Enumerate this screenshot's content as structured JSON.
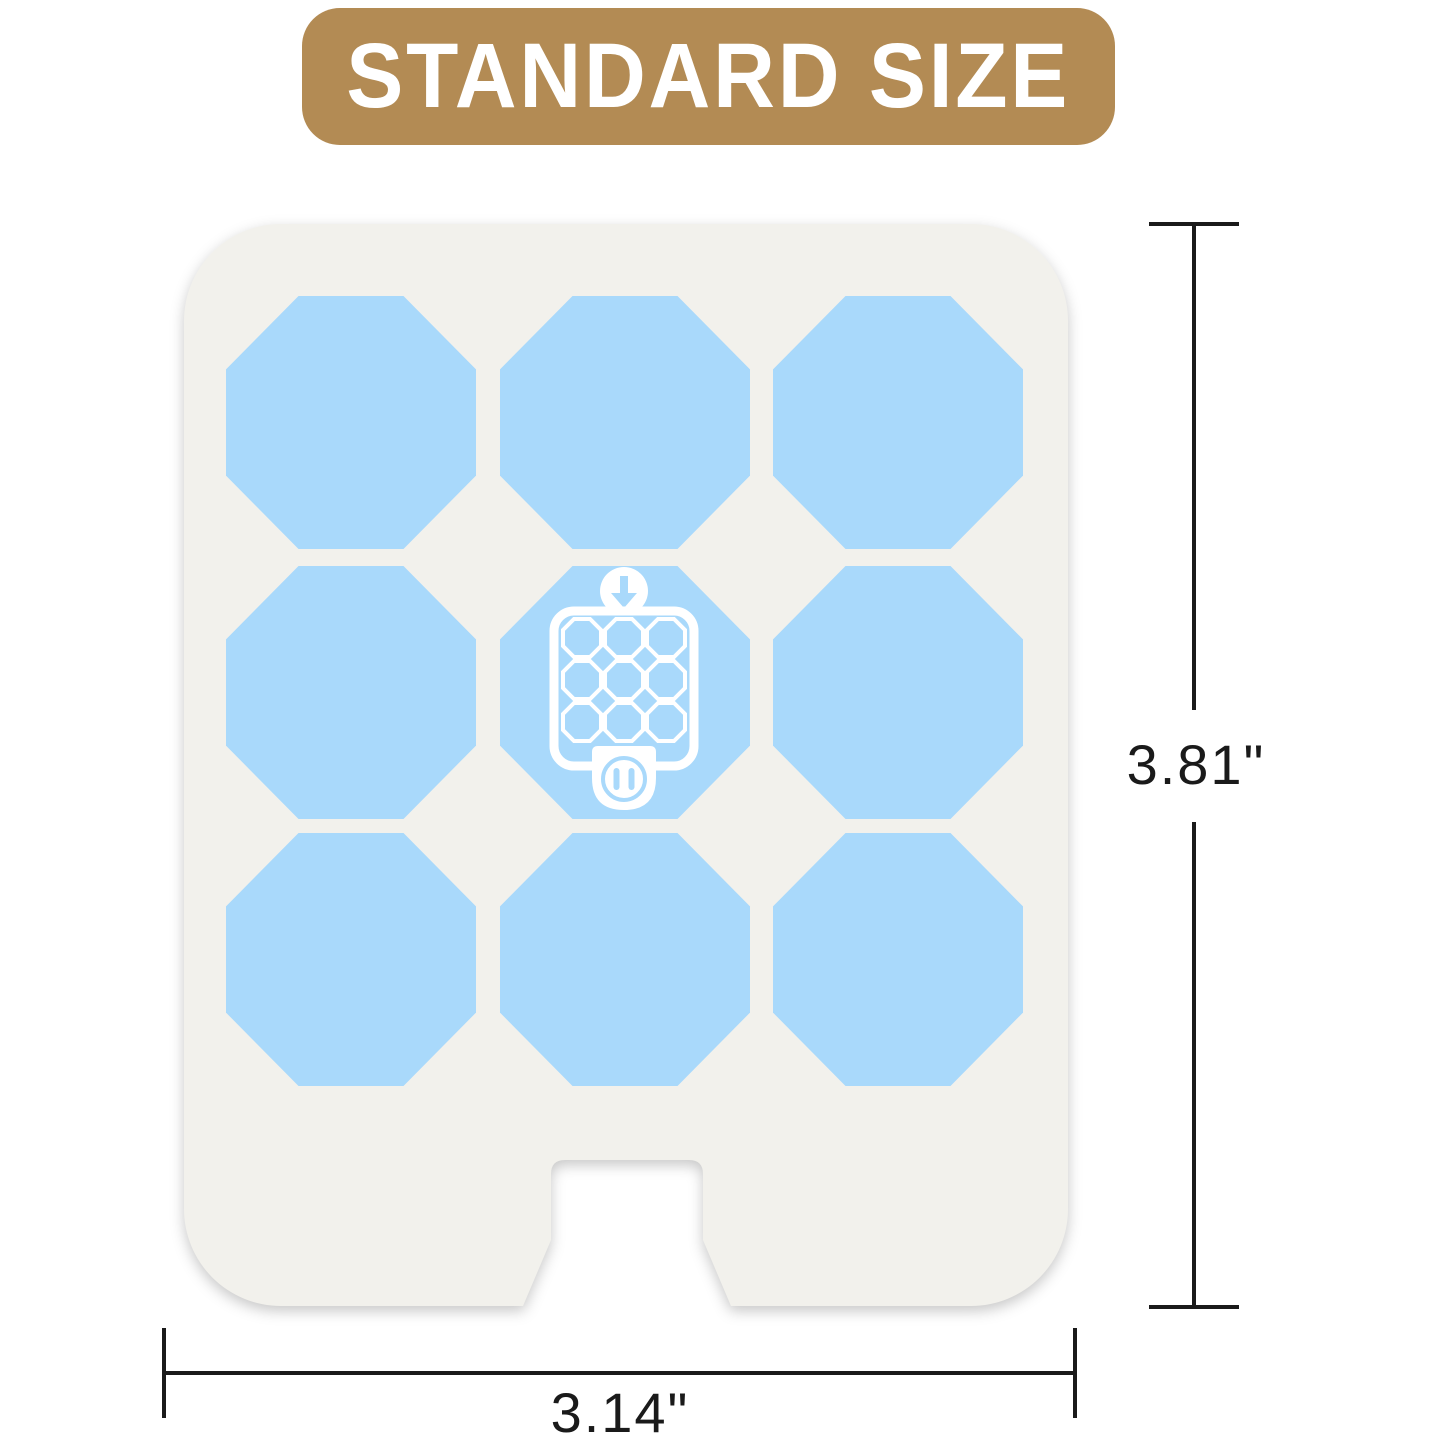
{
  "badge": {
    "label": "STANDARD SIZE"
  },
  "pad": {
    "description": "refill pad sheet with octagon scent pads",
    "octagon_rows": 3,
    "octagon_cols": 3,
    "octagon_count": 9,
    "center_icon": {
      "name": "plug-in-diffuser-icon",
      "elements": [
        "down-arrow-icon",
        "refill-grid-icon",
        "outlet-plug-icon"
      ],
      "mini_octagon_count": 9
    }
  },
  "dimensions": {
    "height_label": "3.81\"",
    "width_label": "3.14\""
  },
  "colors": {
    "tan": "#b38b54",
    "blue": "#a9d9fb",
    "card": "#f2f1ec",
    "line": "#1a1a1a"
  }
}
